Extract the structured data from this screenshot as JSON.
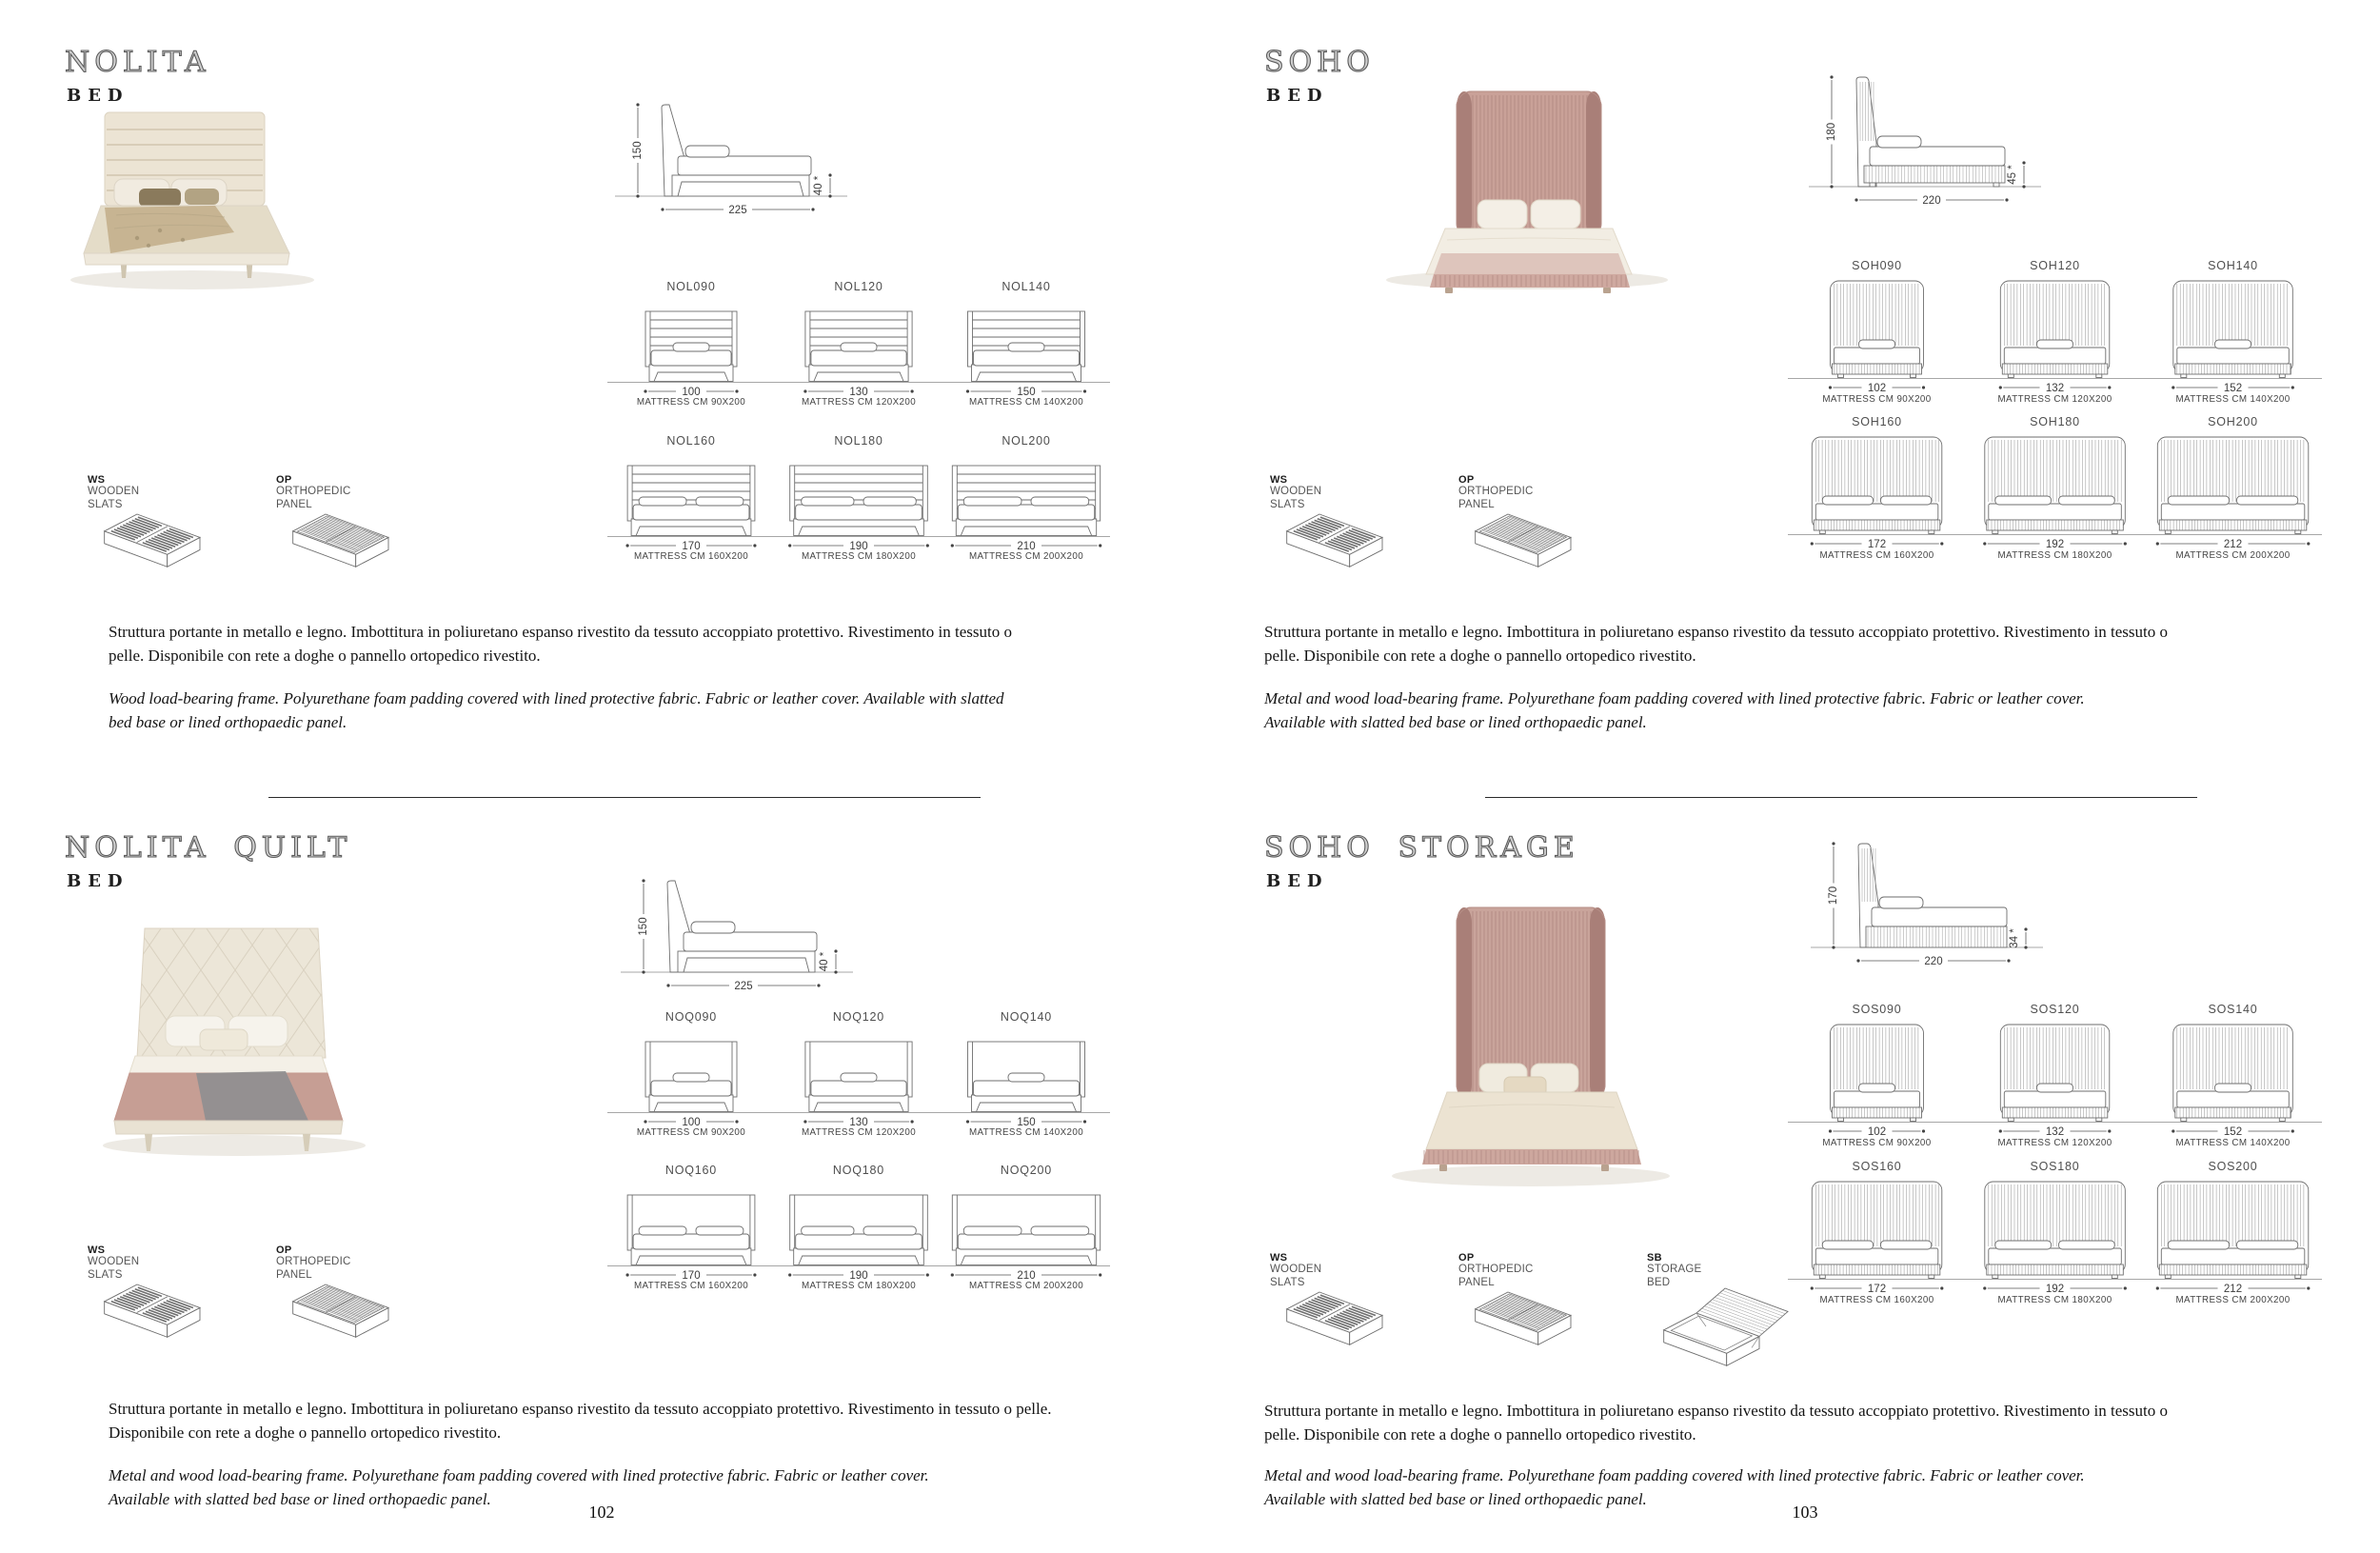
{
  "spread": {
    "page_left": "102",
    "page_right": "103"
  },
  "palette": {
    "line": "#6e6e6e",
    "dim": "#3c3c3c",
    "label": "#454545",
    "hatch": "#9a9a9a",
    "ground": "#8a8a8a",
    "divider": "#2a2a2a",
    "title_outline": "#5c5c5c"
  },
  "products": [
    {
      "id": "nolita",
      "title": "NOLITA",
      "subtitle": "BED",
      "drawing": "panel",
      "side_view": {
        "height": "150",
        "length": "225",
        "base": "40 *"
      },
      "variants": [
        {
          "code": "NOL090",
          "width": "100",
          "mattress": "MATTRESS CM 90X200"
        },
        {
          "code": "NOL120",
          "width": "130",
          "mattress": "MATTRESS CM 120X200"
        },
        {
          "code": "NOL140",
          "width": "150",
          "mattress": "MATTRESS CM 140X200"
        },
        {
          "code": "NOL160",
          "width": "170",
          "mattress": "MATTRESS CM 160X200"
        },
        {
          "code": "NOL180",
          "width": "190",
          "mattress": "MATTRESS CM 180X200"
        },
        {
          "code": "NOL200",
          "width": "210",
          "mattress": "MATTRESS CM 200X200"
        }
      ],
      "features": [
        {
          "code": "WS",
          "label": "WOODEN SLATS",
          "icon": "wooden-slats"
        },
        {
          "code": "OP",
          "label": "ORTHOPEDIC PANEL",
          "icon": "orthopedic-panel"
        }
      ],
      "description_it": "Struttura portante in metallo e legno. Imbottitura in poliuretano espanso rivestito da tessuto accoppiato protettivo. Rivestimento in tessuto o pelle. Disponibile con rete a doghe o pannello ortopedico rivestito.",
      "description_en": "Wood load-bearing frame. Polyurethane foam padding covered with lined protective fabric. Fabric or leather cover. Available with slatted bed base or lined orthopaedic panel.",
      "photo": {
        "style": "nolita",
        "colors": {
          "hb": "#ece4d4",
          "hbLine": "#d8cdb8",
          "bedding": "#e4dcc8",
          "blanket": "#c7b492",
          "accent": "#8a7a5c",
          "accent2": "#b2a383",
          "leg": "#cfc5b0"
        }
      }
    },
    {
      "id": "soho",
      "title": "SOHO",
      "subtitle": "BED",
      "drawing": "wing",
      "side_view": {
        "height": "180",
        "length": "220",
        "base": "45 *"
      },
      "variants": [
        {
          "code": "SOH090",
          "width": "102",
          "mattress": "MATTRESS CM 90X200"
        },
        {
          "code": "SOH120",
          "width": "132",
          "mattress": "MATTRESS CM 120X200"
        },
        {
          "code": "SOH140",
          "width": "152",
          "mattress": "MATTRESS CM 140X200"
        },
        {
          "code": "SOH160",
          "width": "172",
          "mattress": "MATTRESS CM 160X200"
        },
        {
          "code": "SOH180",
          "width": "192",
          "mattress": "MATTRESS CM 180X200"
        },
        {
          "code": "SOH200",
          "width": "212",
          "mattress": "MATTRESS CM 200X200"
        }
      ],
      "features": [
        {
          "code": "WS",
          "label": "WOODEN SLATS",
          "icon": "wooden-slats"
        },
        {
          "code": "OP",
          "label": "ORTHOPEDIC PANEL",
          "icon": "orthopedic-panel"
        }
      ],
      "description_it": "Struttura portante in metallo e legno. Imbottitura in poliuretano espanso rivestito da tessuto accoppiato protettivo. Rivestimento in tessuto o pelle. Disponibile con rete a doghe o pannello ortopedico rivestito.",
      "description_en": "Metal and wood load-bearing frame. Polyurethane foam padding covered with lined protective fabric. Fabric or leather cover. Available with slatted bed base or lined orthopaedic panel.",
      "photo": {
        "style": "soho",
        "colors": {
          "hb": "#c9a198",
          "hbEdge": "#b58d85",
          "pleat": "#b08881",
          "hbDark": "#a97f78",
          "duvet": "#f2ede3",
          "base": "#cfa9a0"
        }
      }
    },
    {
      "id": "nolita-quilt",
      "title": "NOLITA QUILT",
      "subtitle": "BED",
      "drawing": "quilt",
      "side_view": {
        "height": "150",
        "length": "225",
        "base": "40 *"
      },
      "variants": [
        {
          "code": "NOQ090",
          "width": "100",
          "mattress": "MATTRESS CM 90X200"
        },
        {
          "code": "NOQ120",
          "width": "130",
          "mattress": "MATTRESS CM 120X200"
        },
        {
          "code": "NOQ140",
          "width": "150",
          "mattress": "MATTRESS CM 140X200"
        },
        {
          "code": "NOQ160",
          "width": "170",
          "mattress": "MATTRESS CM 160X200"
        },
        {
          "code": "NOQ180",
          "width": "190",
          "mattress": "MATTRESS CM 180X200"
        },
        {
          "code": "NOQ200",
          "width": "210",
          "mattress": "MATTRESS CM 200X200"
        }
      ],
      "features": [
        {
          "code": "WS",
          "label": "WOODEN SLATS",
          "icon": "wooden-slats"
        },
        {
          "code": "OP",
          "label": "ORTHOPEDIC PANEL",
          "icon": "orthopedic-panel"
        }
      ],
      "description_it": "Struttura portante in metallo e legno. Imbottitura in poliuretano espanso rivestito da tessuto accoppiato protettivo. Rivestimento in tessuto o pelle. Disponibile con rete a doghe o pannello ortopedico rivestito.",
      "description_en": "Metal and wood load-bearing frame. Polyurethane foam padding covered with lined protective fabric. Fabric or leather cover. Available with slatted bed base or lined orthopaedic panel.",
      "photo": {
        "style": "quilt",
        "colors": {
          "hb": "#ece6d8",
          "hbLine": "#d9d1c0",
          "bedding": "#c69e94",
          "throw": "#8f8f90"
        }
      }
    },
    {
      "id": "soho-storage",
      "title": "SOHO STORAGE",
      "subtitle": "BED",
      "drawing": "wing-storage",
      "side_view": {
        "height": "170",
        "length": "220",
        "base": "34 *"
      },
      "variants": [
        {
          "code": "SOS090",
          "width": "102",
          "mattress": "MATTRESS CM 90X200"
        },
        {
          "code": "SOS120",
          "width": "132",
          "mattress": "MATTRESS CM 120X200"
        },
        {
          "code": "SOS140",
          "width": "152",
          "mattress": "MATTRESS CM 140X200"
        },
        {
          "code": "SOS160",
          "width": "172",
          "mattress": "MATTRESS CM 160X200"
        },
        {
          "code": "SOS180",
          "width": "192",
          "mattress": "MATTRESS CM 180X200"
        },
        {
          "code": "SOS200",
          "width": "212",
          "mattress": "MATTRESS CM 200X200"
        }
      ],
      "features": [
        {
          "code": "WS",
          "label": "WOODEN SLATS",
          "icon": "wooden-slats"
        },
        {
          "code": "OP",
          "label": "ORTHOPEDIC PANEL",
          "icon": "orthopedic-panel"
        },
        {
          "code": "SB",
          "label": "STORAGE BED",
          "icon": "storage-bed"
        }
      ],
      "description_it": "Struttura portante in metallo e legno. Imbottitura in poliuretano espanso rivestito da tessuto accoppiato protettivo. Rivestimento in tessuto o pelle. Disponibile con rete a doghe o pannello ortopedico rivestito.",
      "description_en": "Metal and wood load-bearing frame. Polyurethane foam padding covered with lined protective fabric. Fabric or leather cover. Available with slatted bed base or lined orthopaedic panel.",
      "photo": {
        "style": "storage",
        "colors": {
          "hb": "#c9a49b",
          "hbEdge": "#b58d85",
          "pleat": "#b08881",
          "hbDark": "#a97f78",
          "duvet": "#ece3d2",
          "base": "#cda79e"
        }
      }
    }
  ]
}
